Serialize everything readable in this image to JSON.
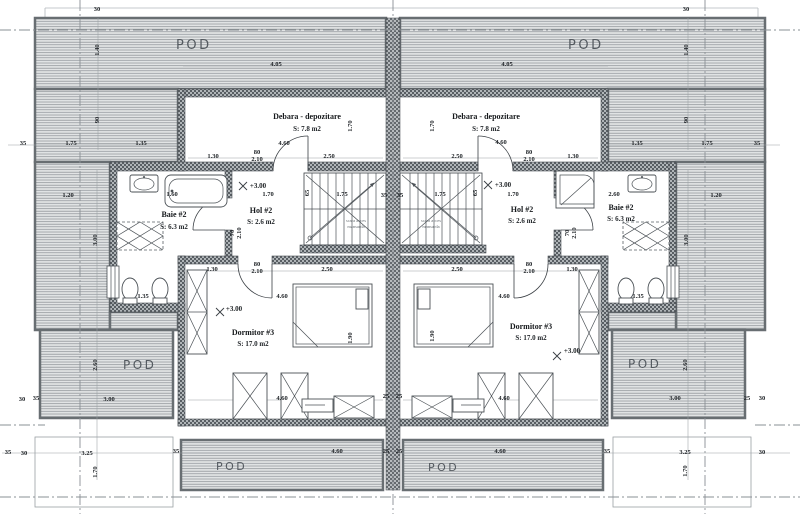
{
  "plan": {
    "colors": {
      "wall_dark": "#585e63",
      "wall_light": "#b0b5b8",
      "hatch_line": "#8b9094",
      "hatch_bg": "#e2e4e5",
      "outline": "#3a3f44",
      "axis": "#8a9095",
      "text": "#15181b"
    },
    "pod_labels": [
      {
        "t": "POD",
        "x": 176,
        "y": 49,
        "s": 13
      },
      {
        "t": "POD",
        "x": 568,
        "y": 49,
        "s": 13
      },
      {
        "t": "POD",
        "x": 123,
        "y": 369,
        "s": 12
      },
      {
        "t": "POD",
        "x": 628,
        "y": 368,
        "s": 12
      },
      {
        "t": "POD",
        "x": 216,
        "y": 470,
        "s": 11
      },
      {
        "t": "POD",
        "x": 428,
        "y": 471,
        "s": 11
      }
    ],
    "rooms": [
      {
        "name": "Debara - depozitare",
        "area": "S: 7.8 m2",
        "x": 307,
        "ny": 119,
        "ay": 131
      },
      {
        "name": "Debara - depozitare",
        "area": "S: 7.8 m2",
        "x": 486,
        "ny": 119,
        "ay": 131
      },
      {
        "name": "Baie #2",
        "area": "S: 6.3 m2",
        "x": 174,
        "ny": 217,
        "ay": 229
      },
      {
        "name": "Baie #2",
        "area": "S: 6.3 m2",
        "x": 621,
        "ny": 210,
        "ay": 221
      },
      {
        "name": "Hol #2",
        "area": "S: 2.6 m2",
        "x": 261,
        "ny": 213,
        "ay": 224
      },
      {
        "name": "Hol #2",
        "area": "S: 2.6 m2",
        "x": 522,
        "ny": 212,
        "ay": 223
      },
      {
        "name": "Dormitor #3",
        "area": "S: 17.0 m2",
        "x": 253,
        "ny": 335,
        "ay": 346
      },
      {
        "name": "Dormitor #3",
        "area": "S: 17.0 m2",
        "x": 531,
        "ny": 329,
        "ay": 340
      }
    ],
    "levels": [
      {
        "t": "+3.00",
        "x": 258,
        "y": 188,
        "cx": 243,
        "cy": 186
      },
      {
        "t": "+3.00",
        "x": 503,
        "y": 187,
        "cx": 488,
        "cy": 185
      },
      {
        "t": "+3.00",
        "x": 234,
        "y": 311,
        "cx": 220,
        "cy": 312
      },
      {
        "t": "+3.00",
        "x": 572,
        "y": 353,
        "cx": 557,
        "cy": 356
      }
    ],
    "stair_notes": [
      {
        "lines": [
          "scara acces",
          "mansarda"
        ],
        "x": 356,
        "y": 222
      },
      {
        "lines": [
          "scara acces",
          "mansarda"
        ],
        "x": 431,
        "y": 222
      }
    ],
    "dimensions": [
      {
        "t": "30",
        "x": 97,
        "y": 11
      },
      {
        "t": "30",
        "x": 686,
        "y": 11
      },
      {
        "t": "4.05",
        "x": 276,
        "y": 66
      },
      {
        "t": "4.05",
        "x": 507,
        "y": 66
      },
      {
        "t": "1.40",
        "x": 99,
        "y": 50,
        "v": 1
      },
      {
        "t": "1.40",
        "x": 688,
        "y": 50,
        "v": 1
      },
      {
        "t": "90",
        "x": 99,
        "y": 120,
        "v": 1
      },
      {
        "t": "90",
        "x": 688,
        "y": 120,
        "v": 1
      },
      {
        "t": "35",
        "x": 23,
        "y": 145
      },
      {
        "t": "1.75",
        "x": 71,
        "y": 145
      },
      {
        "t": "1.35",
        "x": 141,
        "y": 145
      },
      {
        "t": "1.35",
        "x": 637,
        "y": 145
      },
      {
        "t": "1.75",
        "x": 707,
        "y": 145
      },
      {
        "t": "35",
        "x": 757,
        "y": 145
      },
      {
        "t": "4.60",
        "x": 284,
        "y": 145
      },
      {
        "t": "4.60",
        "x": 501,
        "y": 144
      },
      {
        "t": "1.70",
        "x": 352,
        "y": 126,
        "v": 1
      },
      {
        "t": "1.70",
        "x": 434,
        "y": 126,
        "v": 1
      },
      {
        "t": "1.30",
        "x": 213,
        "y": 158
      },
      {
        "t": "80",
        "x": 257,
        "y": 154
      },
      {
        "t": "2.10",
        "x": 257,
        "y": 161
      },
      {
        "t": "2.50",
        "x": 329,
        "y": 158
      },
      {
        "t": "2.50",
        "x": 457,
        "y": 158
      },
      {
        "t": "80",
        "x": 529,
        "y": 154
      },
      {
        "t": "2.10",
        "x": 529,
        "y": 161
      },
      {
        "t": "1.30",
        "x": 573,
        "y": 158
      },
      {
        "t": "1.60",
        "x": 172,
        "y": 196
      },
      {
        "t": "2.60",
        "x": 614,
        "y": 196
      },
      {
        "t": "1.70",
        "x": 268,
        "y": 196
      },
      {
        "t": "1.70",
        "x": 513,
        "y": 196
      },
      {
        "t": "1.20",
        "x": 68,
        "y": 197
      },
      {
        "t": "1.20",
        "x": 716,
        "y": 197
      },
      {
        "t": "65",
        "x": 309,
        "y": 193,
        "v": 1
      },
      {
        "t": "65",
        "x": 477,
        "y": 193,
        "v": 1
      },
      {
        "t": "1.75",
        "x": 342,
        "y": 196
      },
      {
        "t": "35",
        "x": 384,
        "y": 197
      },
      {
        "t": "35",
        "x": 400,
        "y": 197
      },
      {
        "t": "1.75",
        "x": 440,
        "y": 196
      },
      {
        "t": "70",
        "x": 234,
        "y": 233,
        "v": 1
      },
      {
        "t": "2.10",
        "x": 241,
        "y": 233,
        "v": 1
      },
      {
        "t": "70",
        "x": 569,
        "y": 233,
        "v": 1
      },
      {
        "t": "2.10",
        "x": 576,
        "y": 233,
        "v": 1
      },
      {
        "t": "3.00",
        "x": 97,
        "y": 240,
        "v": 1
      },
      {
        "t": "3.00",
        "x": 688,
        "y": 240,
        "v": 1
      },
      {
        "t": "1.30",
        "x": 212,
        "y": 271
      },
      {
        "t": "80",
        "x": 257,
        "y": 266
      },
      {
        "t": "2.10",
        "x": 257,
        "y": 273
      },
      {
        "t": "2.50",
        "x": 327,
        "y": 271
      },
      {
        "t": "2.50",
        "x": 457,
        "y": 271
      },
      {
        "t": "80",
        "x": 529,
        "y": 266
      },
      {
        "t": "2.10",
        "x": 529,
        "y": 273
      },
      {
        "t": "1.30",
        "x": 572,
        "y": 271
      },
      {
        "t": "1.35",
        "x": 143,
        "y": 298
      },
      {
        "t": "1.35",
        "x": 638,
        "y": 298
      },
      {
        "t": "4.60",
        "x": 282,
        "y": 298
      },
      {
        "t": "4.60",
        "x": 504,
        "y": 298
      },
      {
        "t": "1.90",
        "x": 352,
        "y": 338,
        "v": 1
      },
      {
        "t": "1.90",
        "x": 434,
        "y": 336,
        "v": 1
      },
      {
        "t": "25",
        "x": 386,
        "y": 398
      },
      {
        "t": "25",
        "x": 399,
        "y": 398
      },
      {
        "t": "4.60",
        "x": 282,
        "y": 400
      },
      {
        "t": "4.60",
        "x": 504,
        "y": 400
      },
      {
        "t": "2.60",
        "x": 97,
        "y": 365,
        "v": 1
      },
      {
        "t": "2.60",
        "x": 687,
        "y": 365,
        "v": 1
      },
      {
        "t": "3.00",
        "x": 109,
        "y": 401
      },
      {
        "t": "3.00",
        "x": 675,
        "y": 400
      },
      {
        "t": "30",
        "x": 22,
        "y": 401
      },
      {
        "t": "35",
        "x": 36,
        "y": 400
      },
      {
        "t": "25",
        "x": 747,
        "y": 400
      },
      {
        "t": "30",
        "x": 762,
        "y": 400
      },
      {
        "t": "35",
        "x": 176,
        "y": 453
      },
      {
        "t": "4.60",
        "x": 337,
        "y": 453
      },
      {
        "t": "25",
        "x": 386,
        "y": 453
      },
      {
        "t": "25",
        "x": 399,
        "y": 453
      },
      {
        "t": "4.60",
        "x": 500,
        "y": 453
      },
      {
        "t": "35",
        "x": 607,
        "y": 453
      },
      {
        "t": "35",
        "x": 8,
        "y": 454
      },
      {
        "t": "30",
        "x": 24,
        "y": 455
      },
      {
        "t": "3.25",
        "x": 87,
        "y": 455
      },
      {
        "t": "3.25",
        "x": 685,
        "y": 454
      },
      {
        "t": "30",
        "x": 762,
        "y": 454
      },
      {
        "t": "1.70",
        "x": 97,
        "y": 472,
        "v": 1
      },
      {
        "t": "1.70",
        "x": 687,
        "y": 471,
        "v": 1
      }
    ]
  }
}
